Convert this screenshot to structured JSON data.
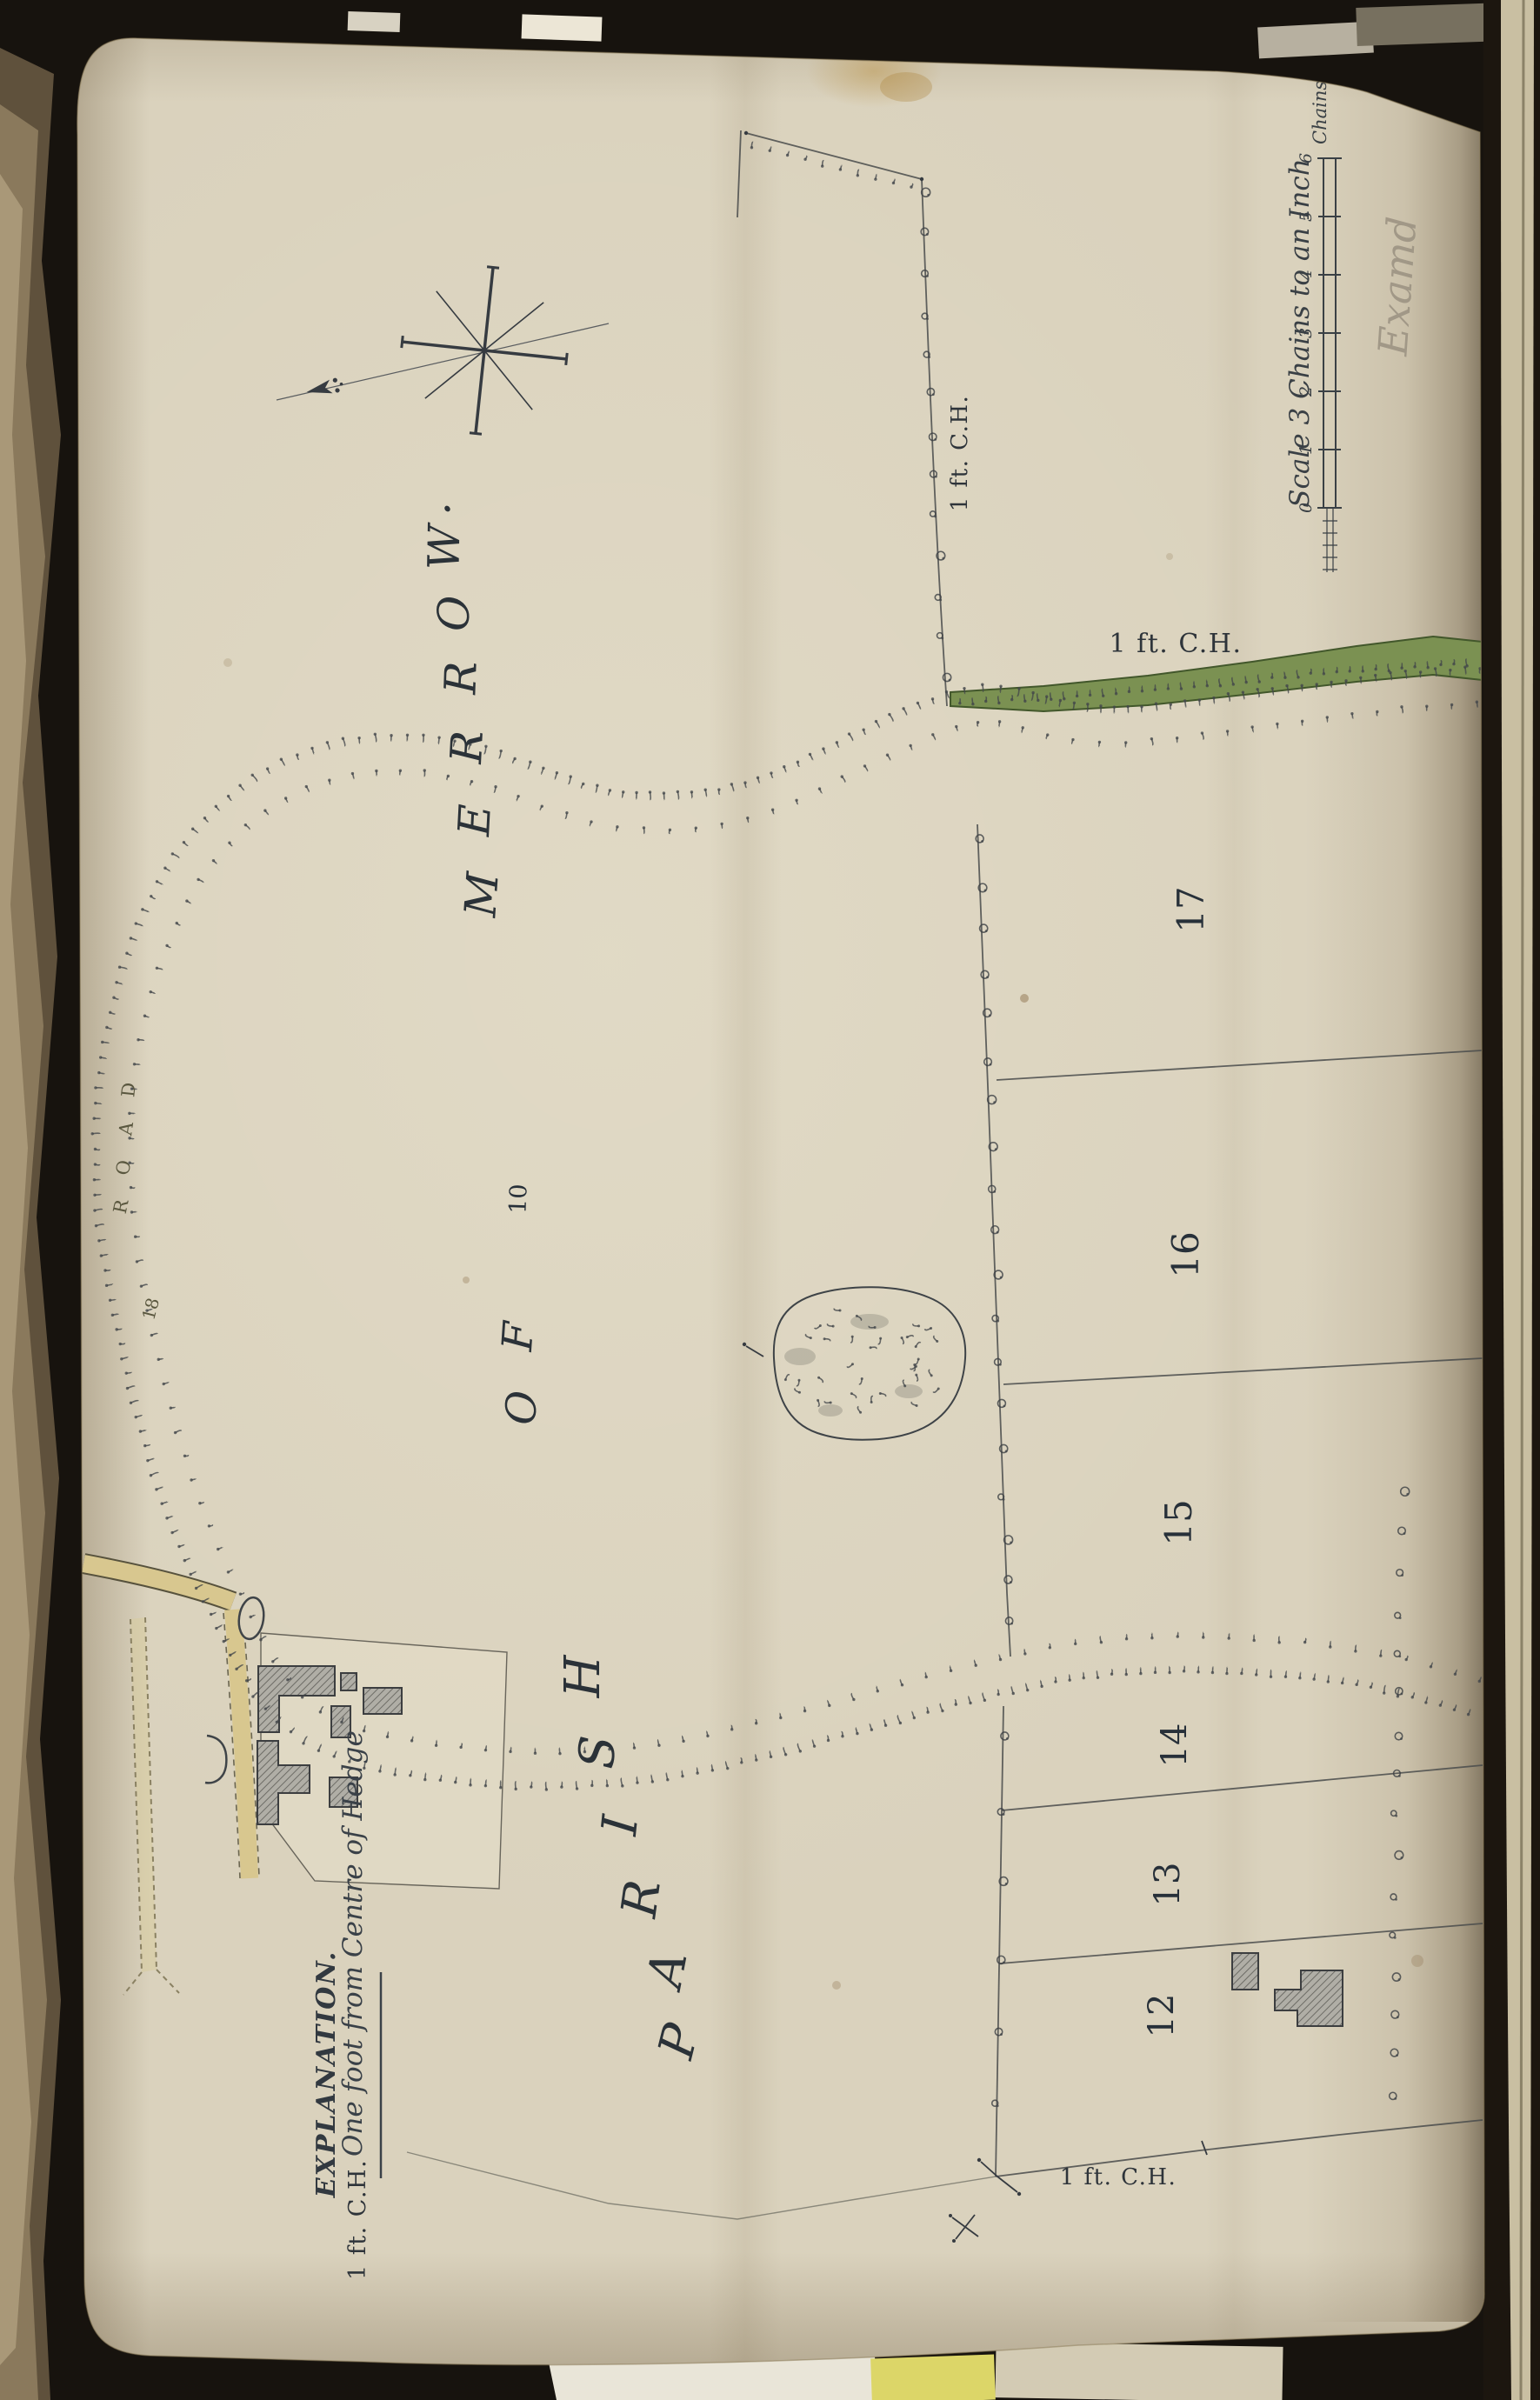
{
  "map": {
    "title": {
      "full": "PARISH OF MERROW.",
      "parish_letters": [
        "P",
        "A",
        "R",
        "I",
        "S",
        "H"
      ],
      "of_letters": [
        "O",
        "F"
      ],
      "merrow_letters": [
        "M",
        "E",
        "R",
        "R",
        "O",
        "W",
        "."
      ]
    },
    "plot_numbers": {
      "p10": "10",
      "p12": "12",
      "p13": "13",
      "p14": "14",
      "p15": "15",
      "p16": "16",
      "p17": "17"
    },
    "road": {
      "letters": [
        "R",
        "O",
        "A",
        "D"
      ],
      "number": "18"
    },
    "hedge_labels": {
      "top": "1 ft. C.H.",
      "green_strip": "1 ft. C.H.",
      "bottom": "1 ft. C.H."
    },
    "legend": {
      "heading": "EXPLANATION.",
      "abbr": "1 ft. C.H.",
      "meaning": "One foot from Centre of Hedge"
    },
    "scale": {
      "caption": "Scale 3 Chains to an Inch",
      "unit_label": "Chains",
      "tick_labels": [
        "0",
        "1",
        "2",
        "3",
        "4",
        "5",
        "6"
      ]
    },
    "annotations": {
      "examined_note": "Examd"
    }
  },
  "colors": {
    "page": "#dad2bd",
    "road_fill": "#d8c78f",
    "road_edge": "#57523d",
    "green_strip": "#7b9152",
    "ink": "#2c3338",
    "pencil": "#9a9181",
    "building_fill": "#a8a69e",
    "building_edge": "#3c3e40"
  }
}
